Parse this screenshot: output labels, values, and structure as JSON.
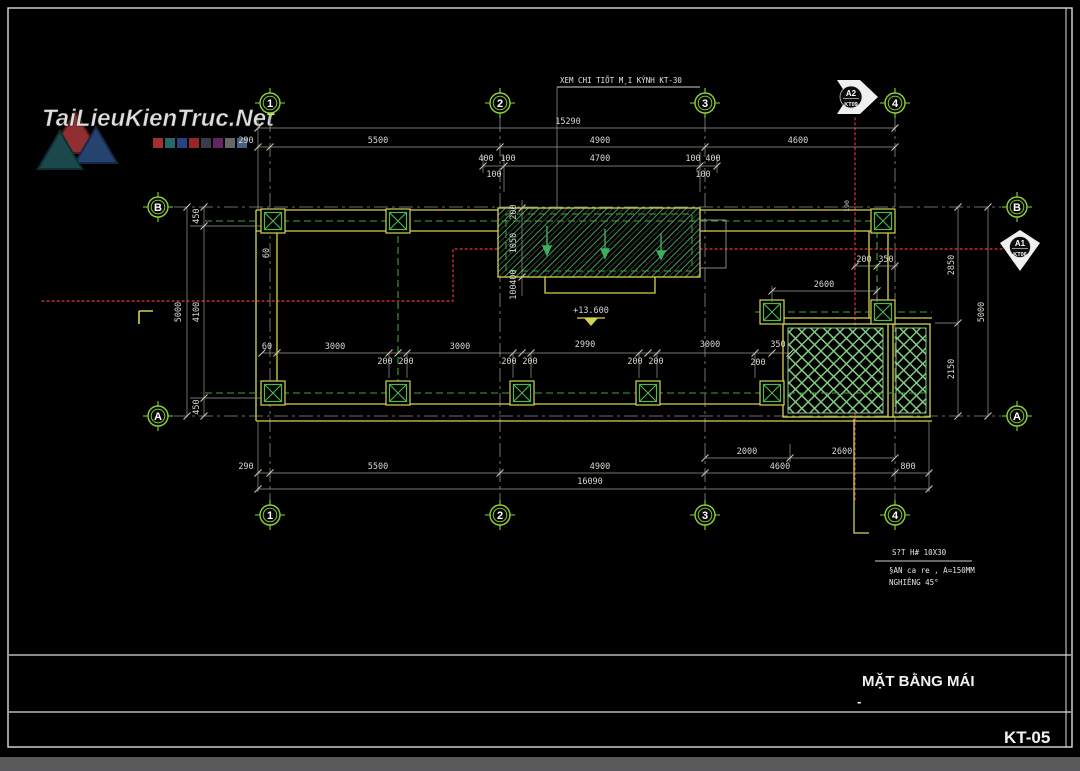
{
  "watermark": {
    "brand": "TaiLieuKienTruc.Net",
    "palette": [
      "#b23434",
      "#2a7070",
      "#2a4a8a",
      "#a52a2a",
      "#3f3f4f",
      "#6a2a6a",
      "#707070",
      "#4a6a8a"
    ]
  },
  "titleblock": {
    "title": "MẶT BẰNG MÁI",
    "dash": "-",
    "sheet": "KT-05"
  },
  "notes": {
    "detail_note": "XEM CHI TIÕT M¸I KÝNH KT-30",
    "hatch_line1": "S?T H# 10X30",
    "hatch_line2": "§AN ca re , A=150MM",
    "hatch_line3": "NGHIÊNG 45°"
  },
  "level": {
    "value": "+13.600"
  },
  "grid_labels": {
    "c1": "1",
    "c2": "2",
    "c3": "3",
    "c4": "4",
    "rA": "A",
    "rB": "B"
  },
  "markers": {
    "top_label": "A2",
    "top_ref": "KT09",
    "right_label": "A1",
    "right_ref": "KT06"
  },
  "dims_top": {
    "overall": "15290",
    "a_290": "290",
    "a_5500": "5500",
    "a_4900": "4900",
    "a_4600": "4600",
    "b_400l": "400",
    "b_100l": "100",
    "b_4700": "4700",
    "b_100r": "100",
    "b_400r": "400",
    "c_100l": "100",
    "c_100r": "100"
  },
  "dims_glass": {
    "g_200": "200",
    "g_1050": "1050",
    "g_400": "400",
    "g_100": "100"
  },
  "dims_left": {
    "overall": "5000",
    "t_450": "450",
    "m_4100": "4100",
    "b_450": "450",
    "w60": "60"
  },
  "dims_mid": {
    "s60": "60",
    "s3000a": "3000",
    "s3000b": "3000",
    "s2990": "2990",
    "s3000c": "3000",
    "s350": "350",
    "o200a": "200",
    "o200b": "200",
    "o200c": "200",
    "o200d": "200",
    "o200e": "200",
    "o200f": "200",
    "o200g": "200"
  },
  "dims_right": {
    "overall": "5000",
    "t_2850": "2850",
    "b_2150": "2150",
    "h_2600": "2600",
    "o200": "200",
    "o350": "350",
    "v190": "190"
  },
  "dims_bottom": {
    "overall": "16090",
    "a_2000": "2000",
    "a_2600": "2600",
    "b_290": "290",
    "b_5500": "5500",
    "b_4900": "4900",
    "b_4600": "4600",
    "b_800": "800"
  },
  "colors": {
    "structure": "#d4d44f",
    "grid_green": "#8fd432",
    "hatch_green": "#7cc87c",
    "section_red": "#c23030"
  }
}
